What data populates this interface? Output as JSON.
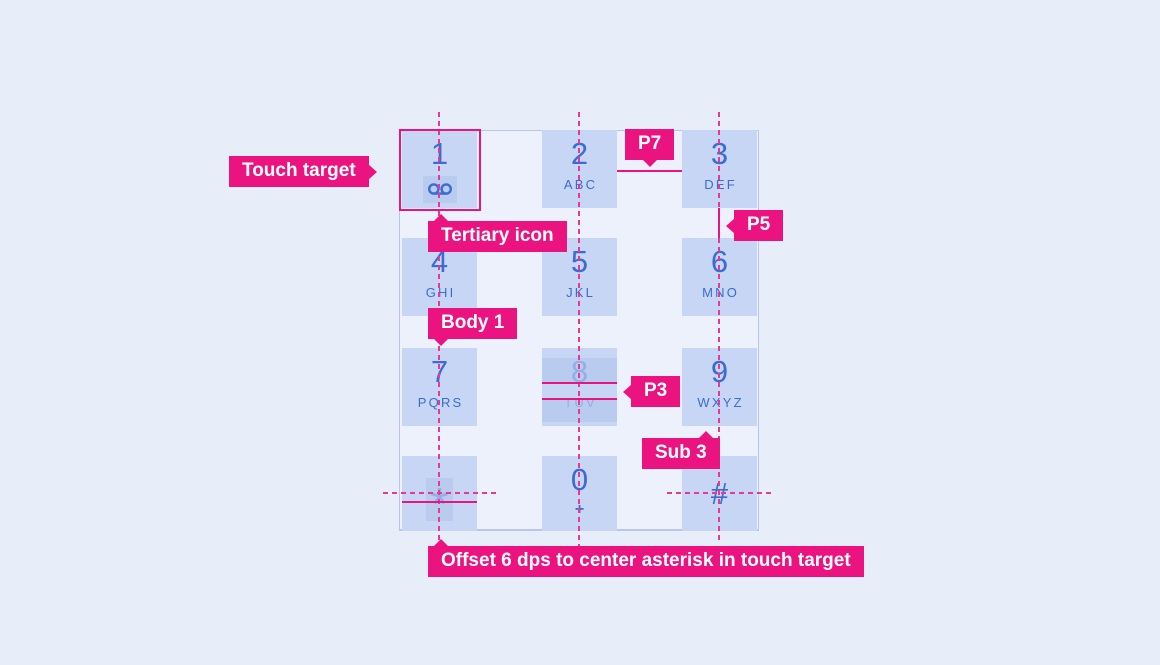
{
  "colors": {
    "page_bg": "#E8EDFA",
    "panel_bg": "#ECF1FC",
    "cell_bg": "#C7D6F4",
    "highlight_band": "#B9CBEF",
    "digit_blue": "#3A6CD4",
    "digit_faded": "#93AFE6",
    "annotation_pink": "#EB1380"
  },
  "keypad": {
    "keys": [
      {
        "name": "key-1",
        "digit": "1",
        "sub": "",
        "icon": "voicemail-icon"
      },
      {
        "name": "key-2",
        "digit": "2",
        "sub": "ABC"
      },
      {
        "name": "key-3",
        "digit": "3",
        "sub": "DEF"
      },
      {
        "name": "key-4",
        "digit": "4",
        "sub": "GHI"
      },
      {
        "name": "key-5",
        "digit": "5",
        "sub": "JKL"
      },
      {
        "name": "key-6",
        "digit": "6",
        "sub": "MNO"
      },
      {
        "name": "key-7",
        "digit": "7",
        "sub": "PQRS"
      },
      {
        "name": "key-8",
        "digit": "8",
        "sub": "TUV",
        "faded": true,
        "highlight_bands": true
      },
      {
        "name": "key-9",
        "digit": "9",
        "sub": "WXYZ"
      },
      {
        "name": "key-star",
        "digit": "*",
        "sub": "",
        "symbol": true,
        "faded": true,
        "highlight_strip": true
      },
      {
        "name": "key-0",
        "digit": "0",
        "sub": "+",
        "plus_sub": true
      },
      {
        "name": "key-hash",
        "digit": "#",
        "sub": "",
        "symbol": true
      }
    ]
  },
  "annotations": {
    "touch_target": {
      "label": "Touch target"
    },
    "p7": {
      "label": "P7"
    },
    "p5": {
      "label": "P5"
    },
    "tertiary_icon": {
      "label": "Tertiary icon"
    },
    "body_1": {
      "label": "Body 1"
    },
    "p3": {
      "label": "P3"
    },
    "sub_3": {
      "label": "Sub 3"
    },
    "offset": {
      "label": "Offset 6 dps to center asterisk in touch target"
    }
  }
}
